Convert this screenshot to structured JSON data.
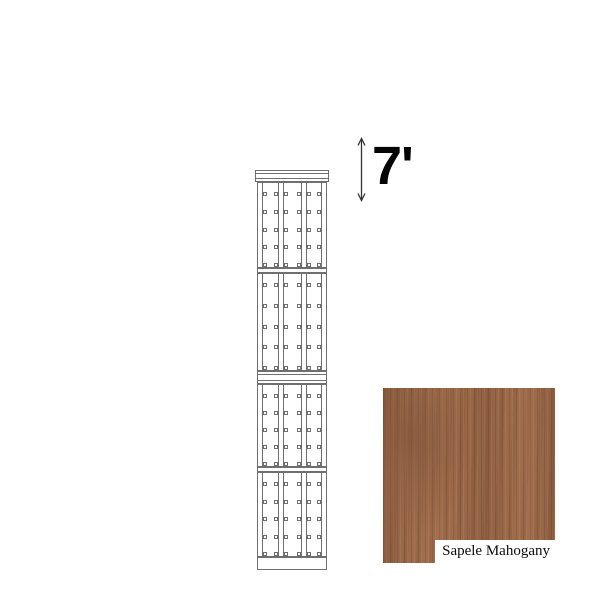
{
  "drawing": {
    "kind": "tall-cabinet-elevation",
    "line_color": "#6f6f6f",
    "columns": 3,
    "sections": [
      {
        "clip_rows": 5
      },
      {
        "clip_rows": 5
      },
      {
        "clip_rows": 5
      },
      {
        "clip_rows": 5
      }
    ]
  },
  "dimension": {
    "label": "7'",
    "arrow_color": "#333333",
    "label_color": "#050505"
  },
  "swatch": {
    "finish_name": "Sapele Mahogany",
    "base_color": "#9c6a4a",
    "dark_grain": "#7b5038",
    "light_grain": "#b27e5b",
    "label_bg": "#ffffff",
    "label_color": "#0b0b0b"
  }
}
